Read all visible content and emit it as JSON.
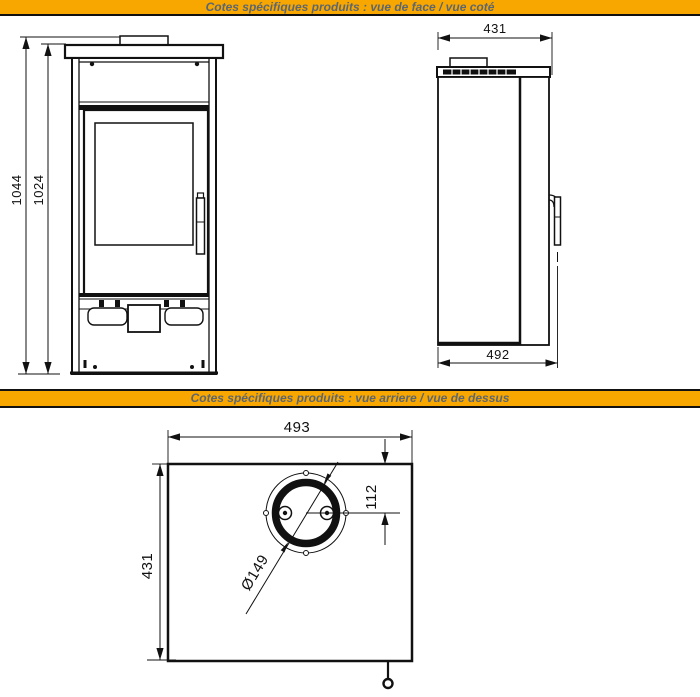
{
  "sections": [
    {
      "title": "Cotes spécifiques produits : vue de face / vue coté"
    },
    {
      "title": "Cotes spécifiques produits : vue arriere / vue de dessus"
    }
  ],
  "colors": {
    "banner_bg": "#F8A700",
    "banner_text": "#5C6670",
    "line": "#111111",
    "background": "#FFFFFF"
  },
  "front_view": {
    "dim_height_total": "1044",
    "dim_height_body": "1024"
  },
  "side_view": {
    "dim_depth_top": "431",
    "dim_depth_overall": "492"
  },
  "top_view": {
    "dim_width": "493",
    "dim_depth": "431",
    "dim_flue_offset": "112",
    "dim_flue_diameter": "Ø149"
  }
}
